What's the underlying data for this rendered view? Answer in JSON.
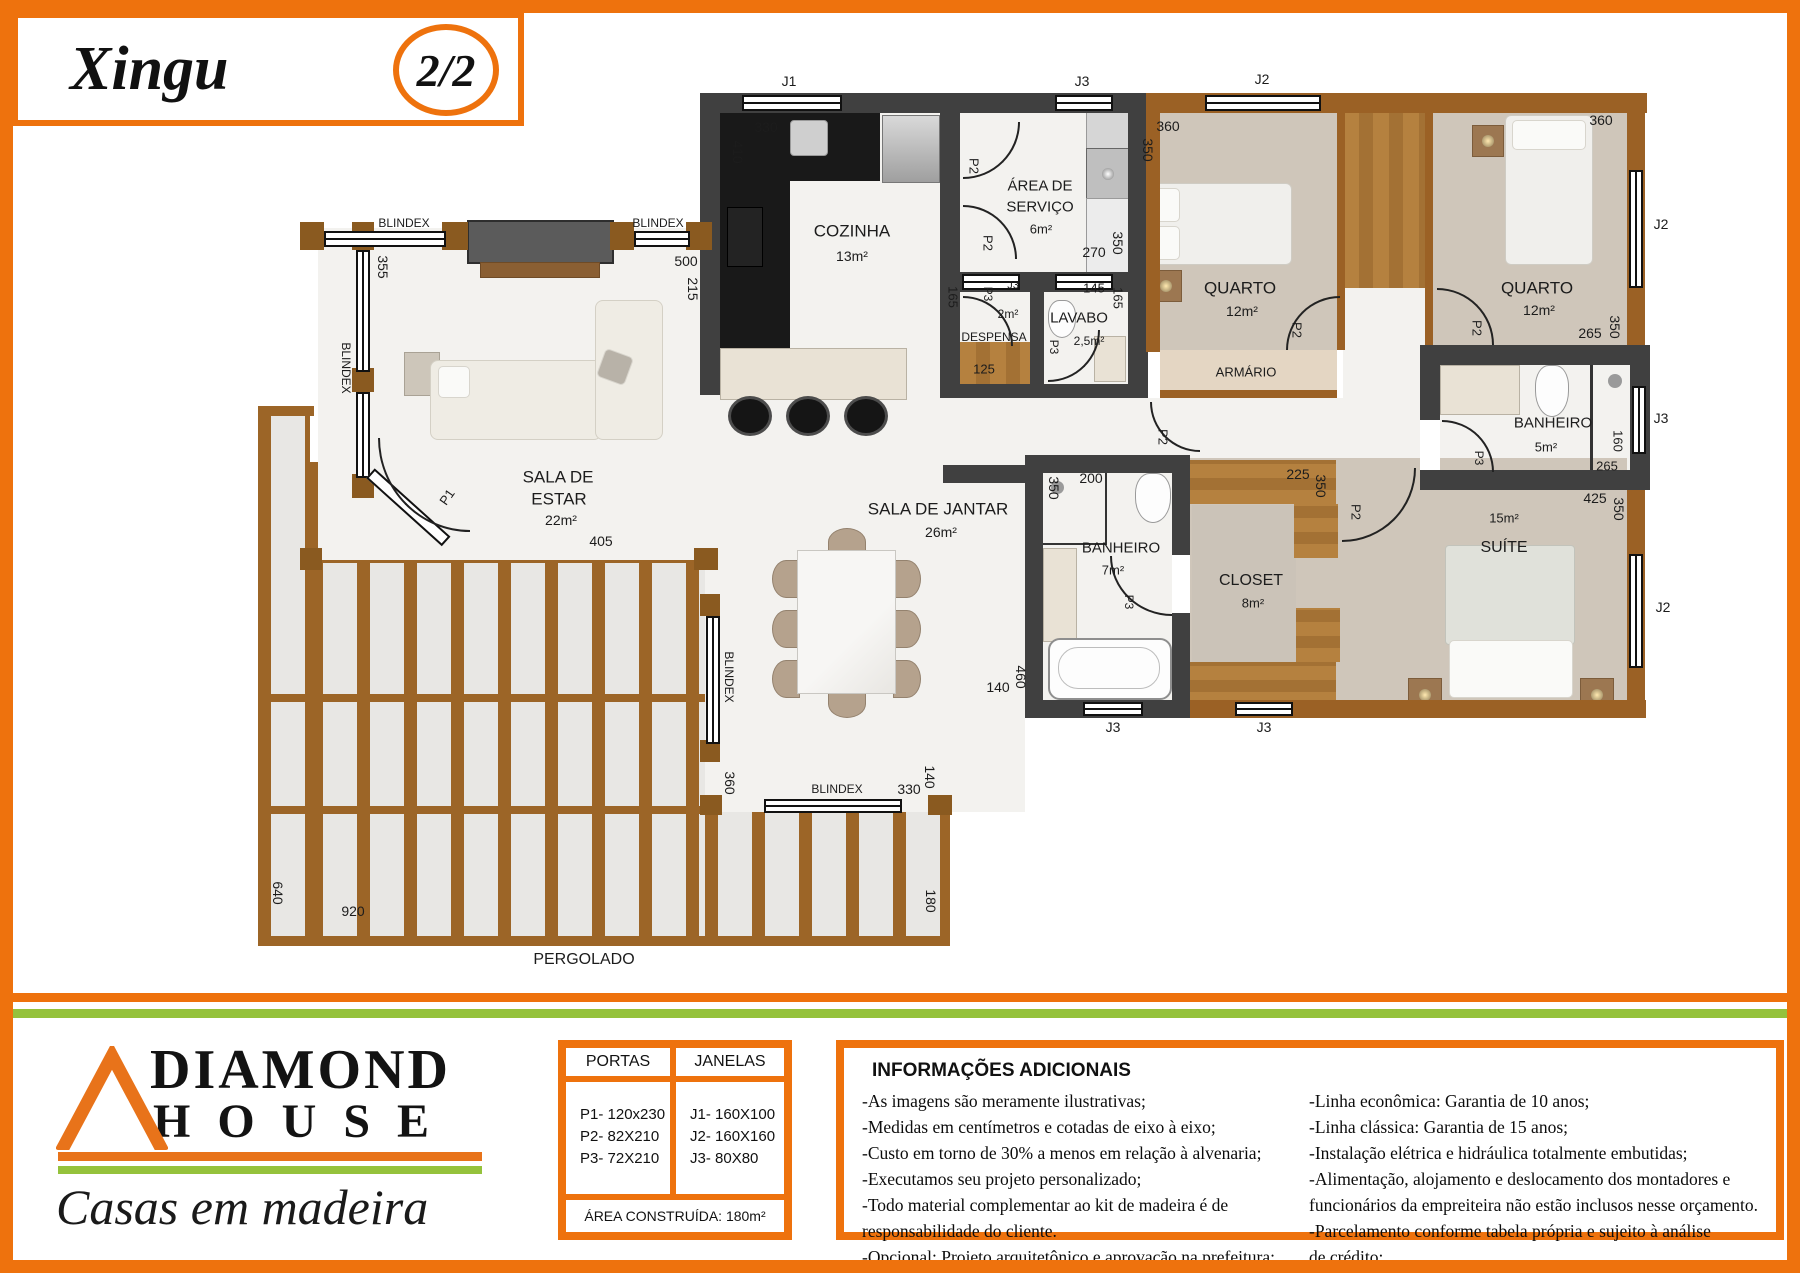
{
  "header": {
    "title": "Xingu",
    "page": "2/2"
  },
  "colors": {
    "orange": "#ee720d",
    "green": "#95c23c",
    "wall_dark": "#404040",
    "wall_wood": "#9b6125",
    "floor_beige": "#cfc6ba",
    "wood_floor": "#b5813f",
    "counter_black": "#191919"
  },
  "plan": {
    "labels": [
      {
        "t": "COZINHA",
        "x": 852,
        "y": 231,
        "r": 0,
        "s": 17
      },
      {
        "t": "13m²",
        "x": 852,
        "y": 256,
        "r": 0,
        "s": 14
      },
      {
        "t": "ÁREA DE",
        "x": 1040,
        "y": 186,
        "r": 0,
        "s": 15
      },
      {
        "t": "SERVIÇO",
        "x": 1040,
        "y": 207,
        "r": 0,
        "s": 15
      },
      {
        "t": "6m²",
        "x": 1041,
        "y": 229,
        "r": 0,
        "s": 13
      },
      {
        "t": "DESPENSA",
        "x": 994,
        "y": 337,
        "r": 0,
        "s": 12
      },
      {
        "t": "2m²",
        "x": 1008,
        "y": 314,
        "r": 0,
        "s": 12
      },
      {
        "t": "LAVABO",
        "x": 1079,
        "y": 318,
        "r": 0,
        "s": 15
      },
      {
        "t": "2,5m²",
        "x": 1089,
        "y": 341,
        "r": 0,
        "s": 12
      },
      {
        "t": "QUARTO",
        "x": 1240,
        "y": 288,
        "r": 0,
        "s": 17
      },
      {
        "t": "12m²",
        "x": 1242,
        "y": 311,
        "r": 0,
        "s": 14
      },
      {
        "t": "QUARTO",
        "x": 1537,
        "y": 288,
        "r": 0,
        "s": 17
      },
      {
        "t": "12m²",
        "x": 1539,
        "y": 310,
        "r": 0,
        "s": 14
      },
      {
        "t": "ARMÁRIO",
        "x": 1246,
        "y": 372,
        "r": 0,
        "s": 13
      },
      {
        "t": "BANHEIRO",
        "x": 1553,
        "y": 423,
        "r": 0,
        "s": 15
      },
      {
        "t": "5m²",
        "x": 1546,
        "y": 447,
        "r": 0,
        "s": 13
      },
      {
        "t": "15m²",
        "x": 1504,
        "y": 518,
        "r": 0,
        "s": 13
      },
      {
        "t": "SUÍTE",
        "x": 1504,
        "y": 548,
        "r": 0,
        "s": 16
      },
      {
        "t": "CLOSET",
        "x": 1251,
        "y": 581,
        "r": 0,
        "s": 16
      },
      {
        "t": "8m²",
        "x": 1253,
        "y": 603,
        "r": 0,
        "s": 13
      },
      {
        "t": "BANHEIRO",
        "x": 1121,
        "y": 548,
        "r": 0,
        "s": 15
      },
      {
        "t": "7m²",
        "x": 1113,
        "y": 570,
        "r": 0,
        "s": 13
      },
      {
        "t": "SALA DE JANTAR",
        "x": 938,
        "y": 509,
        "r": 0,
        "s": 17
      },
      {
        "t": "26m²",
        "x": 941,
        "y": 532,
        "r": 0,
        "s": 14
      },
      {
        "t": "SALA DE",
        "x": 558,
        "y": 477,
        "r": 0,
        "s": 17
      },
      {
        "t": "ESTAR",
        "x": 559,
        "y": 499,
        "r": 0,
        "s": 17
      },
      {
        "t": "22m²",
        "x": 561,
        "y": 520,
        "r": 0,
        "s": 14
      },
      {
        "t": "PERGOLADO",
        "x": 584,
        "y": 960,
        "r": 0,
        "s": 16
      },
      {
        "t": "J1",
        "x": 789,
        "y": 81,
        "r": 0,
        "s": 14
      },
      {
        "t": "J3",
        "x": 1082,
        "y": 81,
        "r": 0,
        "s": 14
      },
      {
        "t": "J2",
        "x": 1262,
        "y": 79,
        "r": 0,
        "s": 14
      },
      {
        "t": "J2",
        "x": 1661,
        "y": 224,
        "r": 0,
        "s": 14
      },
      {
        "t": "J3",
        "x": 1013,
        "y": 286,
        "r": 0,
        "s": 11
      },
      {
        "t": "145",
        "x": 1094,
        "y": 288,
        "r": 0,
        "s": 13
      },
      {
        "t": "J3",
        "x": 1661,
        "y": 418,
        "r": 0,
        "s": 14
      },
      {
        "t": "J2",
        "x": 1663,
        "y": 607,
        "r": 0,
        "s": 14
      },
      {
        "t": "J3",
        "x": 1113,
        "y": 727,
        "r": 0,
        "s": 14
      },
      {
        "t": "J3",
        "x": 1264,
        "y": 727,
        "r": 0,
        "s": 14
      },
      {
        "t": "P1",
        "x": 447,
        "y": 497,
        "r": -55,
        "s": 13
      },
      {
        "t": "P2",
        "x": 974,
        "y": 166,
        "r": 90,
        "s": 13
      },
      {
        "t": "P2",
        "x": 988,
        "y": 243,
        "r": 90,
        "s": 13
      },
      {
        "t": "P2",
        "x": 1163,
        "y": 437,
        "r": 90,
        "s": 13
      },
      {
        "t": "P3",
        "x": 988,
        "y": 294,
        "r": 90,
        "s": 12
      },
      {
        "t": "P3",
        "x": 1054,
        "y": 347,
        "r": 90,
        "s": 12
      },
      {
        "t": "P2",
        "x": 1297,
        "y": 330,
        "r": 90,
        "s": 13
      },
      {
        "t": "P2",
        "x": 1477,
        "y": 328,
        "r": 90,
        "s": 13
      },
      {
        "t": "P2",
        "x": 1356,
        "y": 512,
        "r": 90,
        "s": 13
      },
      {
        "t": "P3",
        "x": 1479,
        "y": 458,
        "r": 90,
        "s": 12
      },
      {
        "t": "P3",
        "x": 1129,
        "y": 602,
        "r": 90,
        "s": 12
      },
      {
        "t": "330",
        "x": 766,
        "y": 127,
        "r": 0,
        "s": 14
      },
      {
        "t": "410",
        "x": 738,
        "y": 152,
        "r": 90,
        "s": 14
      },
      {
        "t": "500",
        "x": 686,
        "y": 261,
        "r": 0,
        "s": 14
      },
      {
        "t": "215",
        "x": 693,
        "y": 289,
        "r": 90,
        "s": 14
      },
      {
        "t": "355",
        "x": 383,
        "y": 267,
        "r": 90,
        "s": 14
      },
      {
        "t": "360",
        "x": 1168,
        "y": 126,
        "r": 0,
        "s": 14
      },
      {
        "t": "350",
        "x": 1148,
        "y": 150,
        "r": 90,
        "s": 14
      },
      {
        "t": "270",
        "x": 1094,
        "y": 252,
        "r": 0,
        "s": 14
      },
      {
        "t": "350",
        "x": 1118,
        "y": 243,
        "r": 90,
        "s": 14
      },
      {
        "t": "165",
        "x": 953,
        "y": 297,
        "r": 90,
        "s": 13
      },
      {
        "t": "125",
        "x": 984,
        "y": 369,
        "r": 0,
        "s": 13
      },
      {
        "t": "165",
        "x": 1118,
        "y": 298,
        "r": 90,
        "s": 13
      },
      {
        "t": "360",
        "x": 1601,
        "y": 120,
        "r": 0,
        "s": 14
      },
      {
        "t": "265",
        "x": 1590,
        "y": 333,
        "r": 0,
        "s": 14
      },
      {
        "t": "350",
        "x": 1615,
        "y": 327,
        "r": 90,
        "s": 14
      },
      {
        "t": "160",
        "x": 1618,
        "y": 441,
        "r": 90,
        "s": 13
      },
      {
        "t": "265",
        "x": 1607,
        "y": 466,
        "r": 0,
        "s": 13
      },
      {
        "t": "425",
        "x": 1595,
        "y": 498,
        "r": 0,
        "s": 14
      },
      {
        "t": "350",
        "x": 1619,
        "y": 509,
        "r": 90,
        "s": 14
      },
      {
        "t": "225",
        "x": 1298,
        "y": 474,
        "r": 0,
        "s": 14
      },
      {
        "t": "350",
        "x": 1321,
        "y": 486,
        "r": 90,
        "s": 14
      },
      {
        "t": "200",
        "x": 1091,
        "y": 478,
        "r": 0,
        "s": 14
      },
      {
        "t": "350",
        "x": 1054,
        "y": 488,
        "r": 90,
        "s": 14
      },
      {
        "t": "140",
        "x": 998,
        "y": 687,
        "r": 0,
        "s": 14
      },
      {
        "t": "460",
        "x": 1021,
        "y": 677,
        "r": 90,
        "s": 14
      },
      {
        "t": "405",
        "x": 601,
        "y": 541,
        "r": 0,
        "s": 14
      },
      {
        "t": "360",
        "x": 730,
        "y": 783,
        "r": 90,
        "s": 14
      },
      {
        "t": "330",
        "x": 909,
        "y": 789,
        "r": 0,
        "s": 14
      },
      {
        "t": "140",
        "x": 930,
        "y": 777,
        "r": 90,
        "s": 14
      },
      {
        "t": "640",
        "x": 278,
        "y": 893,
        "r": 90,
        "s": 14
      },
      {
        "t": "920",
        "x": 353,
        "y": 911,
        "r": 0,
        "s": 14
      },
      {
        "t": "180",
        "x": 931,
        "y": 901,
        "r": 90,
        "s": 14
      },
      {
        "t": "BLINDEX",
        "x": 404,
        "y": 223,
        "r": 0,
        "s": 12
      },
      {
        "t": "BLINDEX",
        "x": 658,
        "y": 223,
        "r": 0,
        "s": 12
      },
      {
        "t": "BLINDEX",
        "x": 346,
        "y": 368,
        "r": 90,
        "s": 12
      },
      {
        "t": "BLINDEX",
        "x": 729,
        "y": 677,
        "r": 90,
        "s": 12
      },
      {
        "t": "BLINDEX",
        "x": 837,
        "y": 789,
        "r": 0,
        "s": 12
      }
    ]
  },
  "legend": {
    "portas_title": "PORTAS",
    "janelas_title": "JANELAS",
    "portas": [
      "P1- 120x230",
      "P2- 82X210",
      "P3- 72X210"
    ],
    "janelas": [
      "J1- 160X100",
      "J2- 160X160",
      "J3- 80X80"
    ],
    "area": "ÁREA CONSTRUÍDA: 180m²"
  },
  "info": {
    "title": "INFORMAÇÕES ADICIONAIS",
    "left": [
      "-As imagens são meramente ilustrativas;",
      "-Medidas em centímetros e cotadas de eixo à eixo;",
      "-Custo em torno de 30% a menos em relação à alvenaria;",
      "-Executamos seu projeto personalizado;",
      "-Todo material complementar ao kit de madeira é de",
      "responsabilidade do cliente.",
      "-Opcional: Projeto arquitetônico e aprovação na prefeitura;"
    ],
    "right": [
      "-Linha econômica: Garantia de 10 anos;",
      "-Linha clássica: Garantia de 15 anos;",
      "-Instalação elétrica e hidráulica totalmente embutidas;",
      "-Alimentação, alojamento e deslocamento dos montadores e",
      "funcionários da empreiteira não estão inclusos nesse orçamento.",
      "-Parcelamento conforme tabela própria e sujeito à análise",
      "de crédito;"
    ]
  },
  "brand": {
    "line1": "DIAMOND",
    "line2": "HOUSE",
    "tagline": "Casas em madeira"
  }
}
